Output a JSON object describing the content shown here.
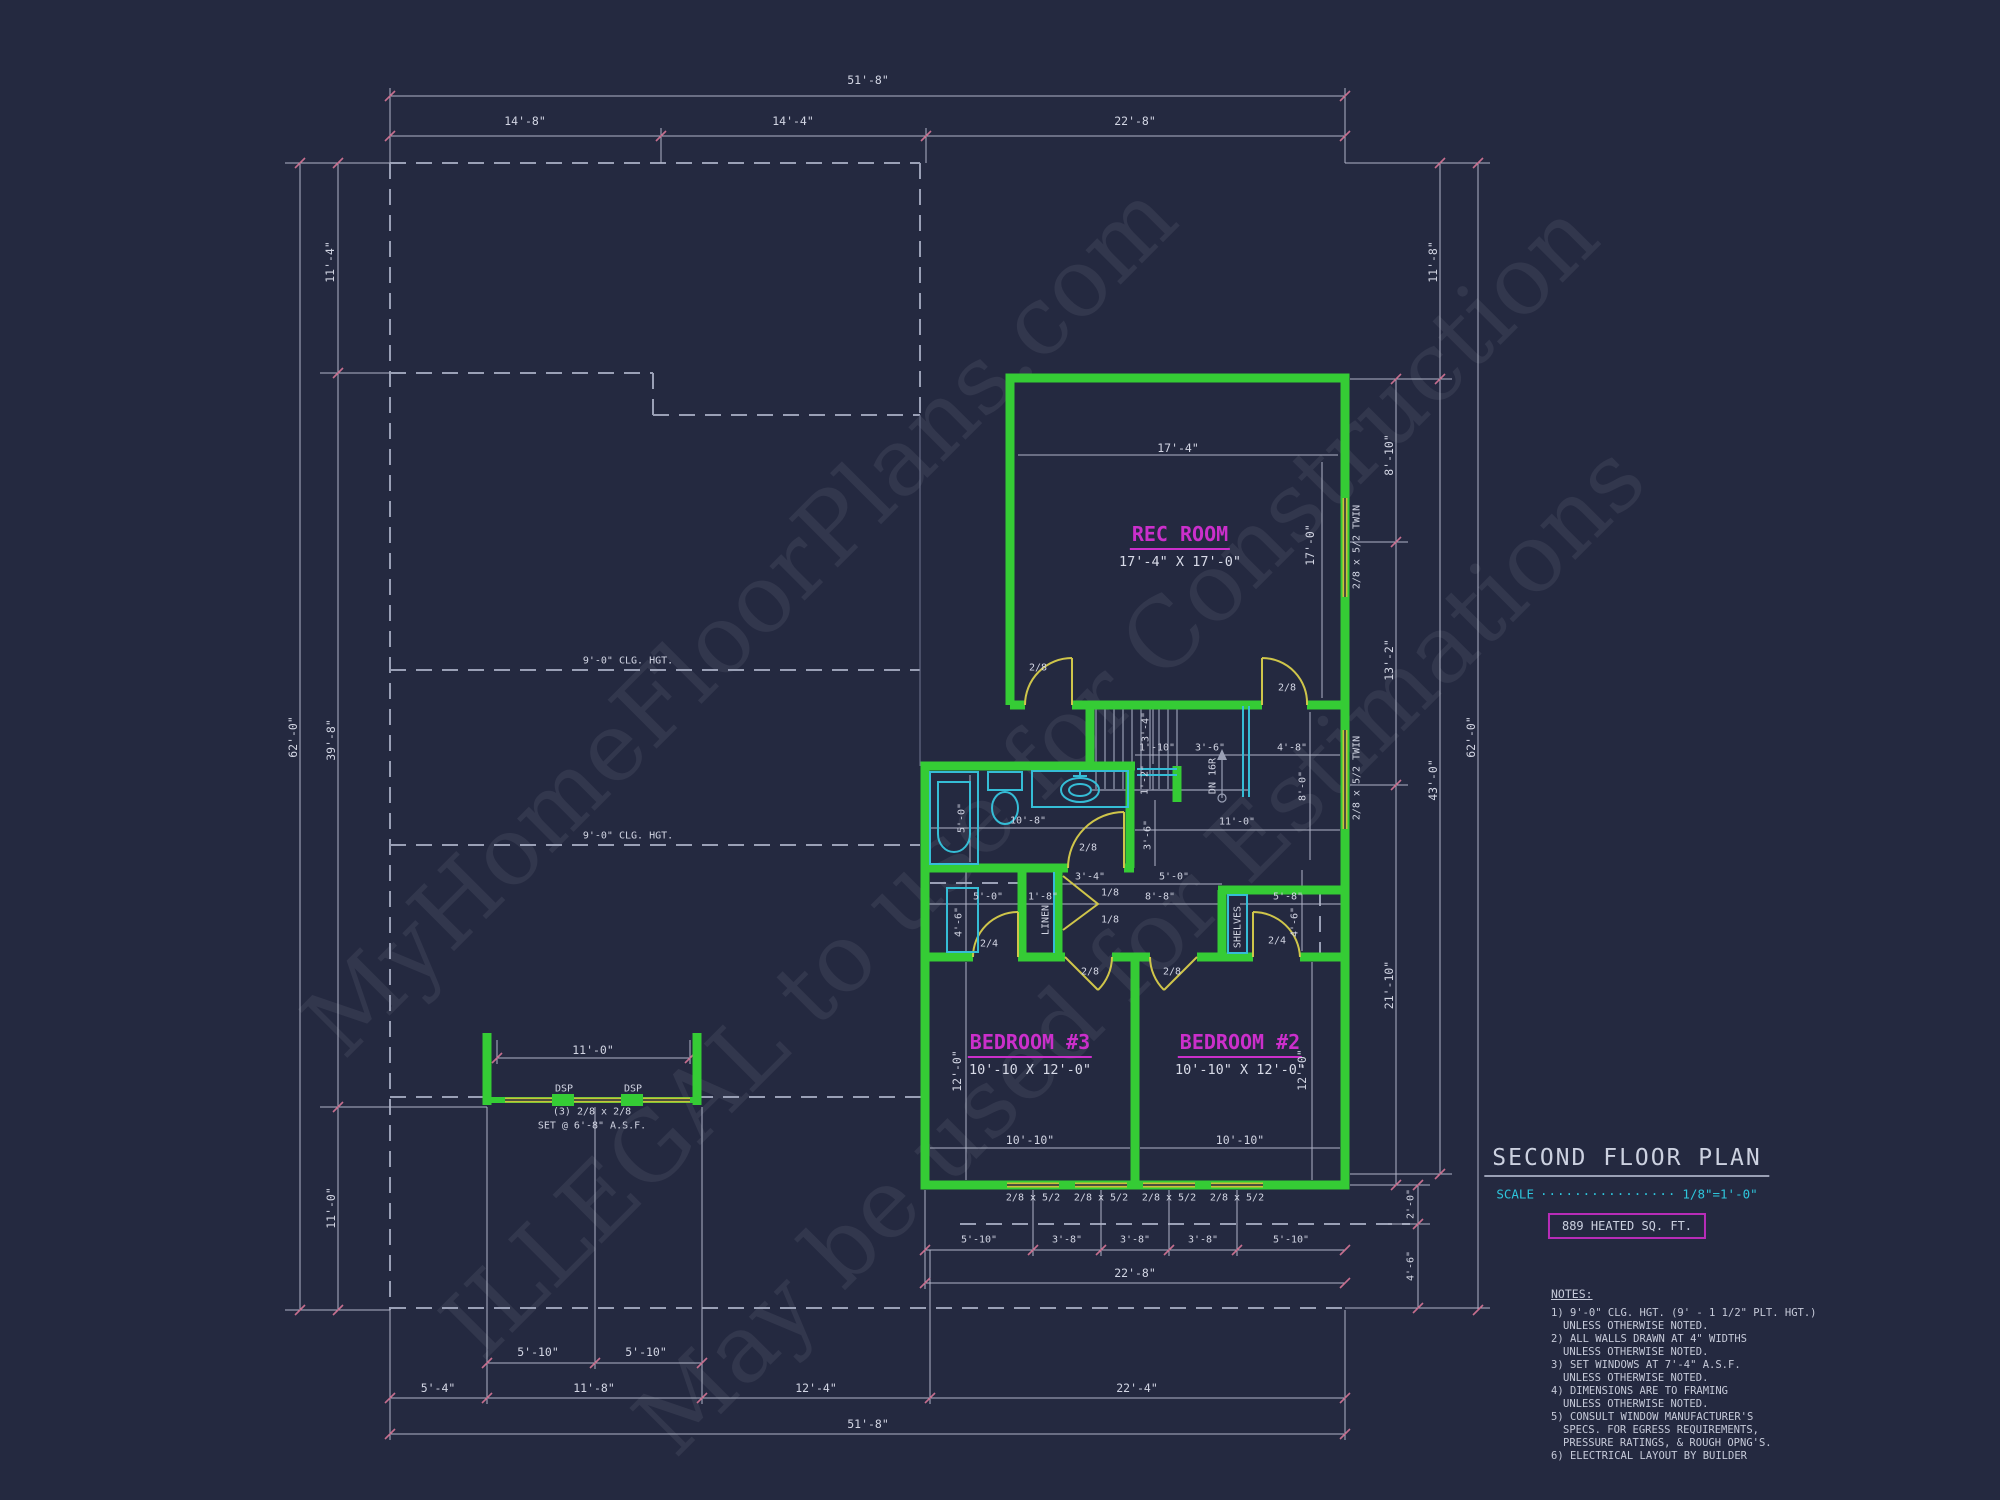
{
  "watermark": [
    "MyHomeFloorPlans.com",
    "ILLEGAL to use for Construction",
    "May be used for Estimations"
  ],
  "rooms": {
    "rec": {
      "name": "REC ROOM",
      "size": "17'-4\" X 17'-0\""
    },
    "bed3": {
      "name": "BEDROOM #3",
      "size": "10'-10 X 12'-0\""
    },
    "bed2": {
      "name": "BEDROOM #2",
      "size": "10'-10\" X 12'-0\""
    }
  },
  "annotations": {
    "stairs": "DN 16R",
    "linen": "LINEN",
    "shelves": "SHELVES",
    "ceiling": [
      "9'-0\" CLG. HGT.",
      "9'-0\" CLG. HGT."
    ],
    "deck_posts": [
      "DSP",
      "DSP"
    ],
    "balcony_window": "(3) 2/8 x 2/8",
    "balcony_set": "SET @ 6'-8\" A.S.F."
  },
  "doors": {
    "rec_left": "2/8",
    "rec_right": "2/8",
    "bath": "2/8",
    "bed3": "2/8",
    "bed2": "2/8",
    "closet3": "2/4",
    "closet2": "2/4",
    "bifold": [
      "1/8",
      "1/8"
    ]
  },
  "windows": {
    "twin": [
      "2/8 x 5/2 TWIN",
      "2/8 x 5/2 TWIN"
    ],
    "bottom": [
      "2/8 x 5/2",
      "2/8 x 5/2",
      "2/8 x 5/2",
      "2/8 x 5/2"
    ]
  },
  "dims": {
    "top_total": "51'-8\"",
    "top": [
      "14'-8\"",
      "14'-4\"",
      "22'-8\""
    ],
    "left": [
      "11'-4\"",
      "62'-0\"",
      "39'-8\"",
      "11'-0\""
    ],
    "right": [
      "11'-8\"",
      "8'-10\"",
      "13'-2\"",
      "43'-0\"",
      "62'-0\"",
      "21'-10\"",
      "2'-0\"",
      "4'-6\""
    ],
    "bottom_pair": [
      "5'-10\"",
      "5'-10\""
    ],
    "bottom": [
      "5'-4\"",
      "11'-8\"",
      "12'-4\"",
      "22'-4\""
    ],
    "bottom_total": "51'-8\"",
    "win_row": [
      "5'-10\"",
      "3'-8\"",
      "3'-8\"",
      "3'-8\"",
      "5'-10\""
    ],
    "win_total": "22'-8\"",
    "rec_w": "17'-4\"",
    "rec_h": "17'-0\"",
    "stair": [
      "3'-4\"",
      "1'-10\"",
      "3'-6\"",
      "4'-8\"",
      "1'-2\"",
      "8'-0\"",
      "11'-0\"",
      "3'-6\"",
      "3'-4\"",
      "5'-0\""
    ],
    "hall": [
      "5'-0\"",
      "1'-8\"",
      "8'-8\"",
      "4'-6\"",
      "5'-8\"",
      "4'-6\""
    ],
    "bath": [
      "5'-0\"",
      "10'-8\""
    ],
    "bed3": [
      "10'-10\"",
      "12'-0\""
    ],
    "bed2": [
      "10'-10\"",
      "12'-0\""
    ],
    "balcony": "11'-0\""
  },
  "title_block": {
    "title": "SECOND FLOOR PLAN",
    "scale_label": "SCALE",
    "scale_dots": "················",
    "scale_value": "1/8\"=1'-0\"",
    "heated_area": "889 HEATED SQ. FT.",
    "notes_title": "NOTES:",
    "notes": [
      "1) 9'-0\" CLG. HGT. (9' - 1 1/2\" PLT. HGT.)",
      "UNLESS OTHERWISE NOTED.",
      "2) ALL WALLS DRAWN AT 4\" WIDTHS",
      "UNLESS OTHERWISE NOTED.",
      "3) SET WINDOWS AT 7'-4\" A.S.F.",
      "UNLESS OTHERWISE NOTED.",
      "4) DIMENSIONS ARE TO FRAMING",
      "UNLESS OTHERWISE NOTED.",
      "5) CONSULT WINDOW MANUFACTURER'S",
      "SPECS. FOR EGRESS REQUIREMENTS,",
      "PRESSURE RATINGS, & ROUGH OPNG'S.",
      "6) ELECTRICAL LAYOUT BY BUILDER"
    ]
  },
  "colors": {
    "background": "#242940",
    "wall": "#35cc35",
    "window": "#c9c23a",
    "fixture": "#35bdd6",
    "room_label": "#cb2fcb",
    "dimension_text": "#d2d5e3",
    "scale_text": "#2ec6dc",
    "heated_box": "#b82cb8",
    "watermark": "#c9cedd"
  }
}
